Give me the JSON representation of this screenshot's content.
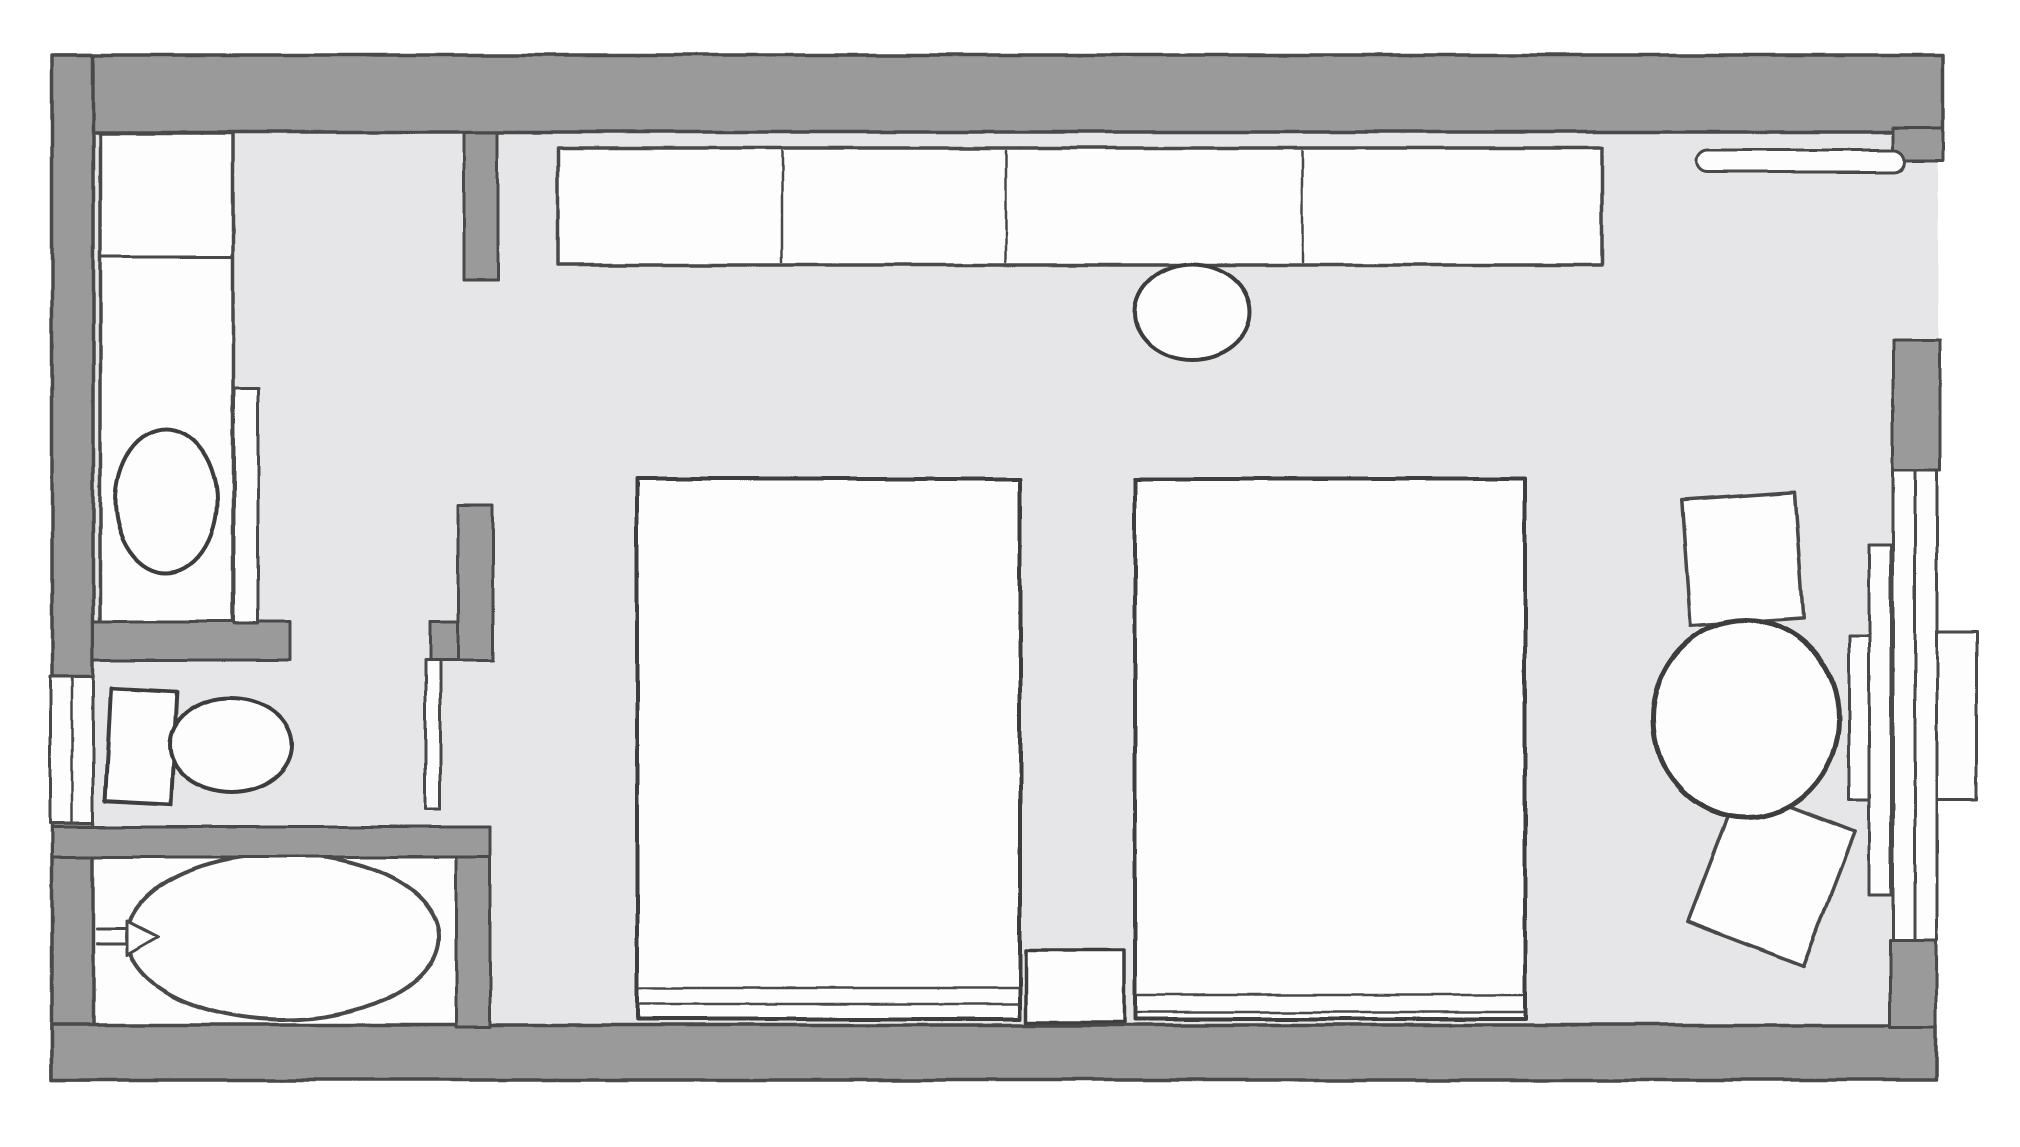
{
  "canvas": {
    "width": 2020,
    "height": 1147
  },
  "palette": {
    "bg": "#ffffff",
    "floor": "#e6e6e8",
    "wall": "#9a9a9a",
    "fixture": "#fdfdfd",
    "outline": "#4a4a4a",
    "outline_dark": "#3c3c3c"
  },
  "shapes": [
    {
      "name": "room-floor",
      "type": "rect",
      "x": 58,
      "y": 58,
      "w": 1880,
      "h": 1020,
      "fill": "floor",
      "stroke": "none",
      "sw": 0
    },
    {
      "name": "bathtub-room-floor",
      "type": "rect",
      "x": 90,
      "y": 843,
      "w": 368,
      "h": 186,
      "fill": "fixture",
      "stroke": "outline",
      "sw": 3
    },
    {
      "name": "vanity-counter",
      "type": "rect",
      "x": 100,
      "y": 133,
      "w": 133,
      "h": 492,
      "fill": "fixture",
      "stroke": "outline",
      "sw": 3.5
    },
    {
      "name": "vanity-shelf-divider-line",
      "type": "line",
      "x1": 100,
      "y1": 257,
      "x2": 233,
      "y2": 257,
      "fill": "none",
      "stroke": "outline",
      "sw": 3
    },
    {
      "name": "sink-basin",
      "type": "ellipse",
      "cx": 166,
      "cy": 501,
      "rx": 51,
      "ry": 72,
      "fill": "fixture",
      "stroke": "outline_dark",
      "sw": 4
    },
    {
      "name": "wardrobe-console-cabinet",
      "type": "rect",
      "x": 558,
      "y": 148,
      "w": 1044,
      "h": 117,
      "fill": "fixture",
      "stroke": "outline",
      "sw": 3.5
    },
    {
      "name": "cabinet-divider-line-1",
      "type": "line",
      "x1": 782,
      "y1": 151,
      "x2": 782,
      "y2": 262,
      "fill": "none",
      "stroke": "outline",
      "sw": 2.5
    },
    {
      "name": "cabinet-divider-line-2",
      "type": "line",
      "x1": 1006,
      "y1": 151,
      "x2": 1006,
      "y2": 262,
      "fill": "none",
      "stroke": "outline",
      "sw": 2.5
    },
    {
      "name": "cabinet-divider-line-3",
      "type": "line",
      "x1": 1302,
      "y1": 151,
      "x2": 1302,
      "y2": 262,
      "fill": "none",
      "stroke": "outline",
      "sw": 2.5
    },
    {
      "name": "stool-seat",
      "type": "ellipse",
      "cx": 1192,
      "cy": 312,
      "rx": 58,
      "ry": 48,
      "fill": "fixture",
      "stroke": "outline_dark",
      "sw": 4
    },
    {
      "name": "bed-left",
      "type": "rect",
      "x": 637,
      "y": 479,
      "w": 383,
      "h": 540,
      "fill": "fixture",
      "stroke": "outline_dark",
      "sw": 4
    },
    {
      "name": "bed-left-headboard-line-1",
      "type": "line",
      "x1": 640,
      "y1": 988,
      "x2": 1018,
      "y2": 988,
      "fill": "none",
      "stroke": "outline",
      "sw": 2.5
    },
    {
      "name": "bed-left-headboard-line-2",
      "type": "line",
      "x1": 640,
      "y1": 1004,
      "x2": 1018,
      "y2": 1004,
      "fill": "none",
      "stroke": "outline",
      "sw": 2.5
    },
    {
      "name": "bed-right",
      "type": "rect",
      "x": 1135,
      "y": 479,
      "w": 390,
      "h": 540,
      "fill": "fixture",
      "stroke": "outline_dark",
      "sw": 4
    },
    {
      "name": "bed-right-headboard-line-1",
      "type": "line",
      "x1": 1138,
      "y1": 995,
      "x2": 1522,
      "y2": 995,
      "fill": "none",
      "stroke": "outline",
      "sw": 2.5
    },
    {
      "name": "bed-right-headboard-line-2",
      "type": "line",
      "x1": 1138,
      "y1": 1012,
      "x2": 1522,
      "y2": 1012,
      "fill": "none",
      "stroke": "outline",
      "sw": 2.5
    },
    {
      "name": "nightstand",
      "type": "rect",
      "x": 1026,
      "y": 950,
      "w": 98,
      "h": 72,
      "fill": "fixture",
      "stroke": "outline_dark",
      "sw": 3.5
    },
    {
      "name": "chair-top",
      "type": "rect",
      "x": 1686,
      "y": 496,
      "w": 113,
      "h": 126,
      "rot": -4,
      "fill": "fixture",
      "stroke": "outline",
      "sw": 3.5
    },
    {
      "name": "chair-bottom",
      "type": "rect",
      "x": 1709,
      "y": 805,
      "w": 124,
      "h": 144,
      "rot": 21,
      "fill": "fixture",
      "stroke": "outline",
      "sw": 3.5
    },
    {
      "name": "round-table",
      "type": "ellipse",
      "cx": 1746,
      "cy": 719,
      "rx": 93,
      "ry": 99,
      "fill": "fixture",
      "stroke": "outline_dark",
      "sw": 5
    },
    {
      "name": "bathtub",
      "type": "ellipse",
      "cx": 283,
      "cy": 937,
      "rx": 156,
      "ry": 83,
      "fill": "fixture",
      "stroke": "outline",
      "sw": 4
    },
    {
      "name": "bathtub-faucet",
      "type": "path",
      "d": "M97 929 L127 929 M97 944 L127 944 M127 921 L158 937 L127 955 Z",
      "fill": "fixture",
      "stroke": "outline",
      "sw": 3
    },
    {
      "name": "toilet-tank",
      "type": "rect",
      "x": 108,
      "y": 690,
      "w": 66,
      "h": 113,
      "rot": 3,
      "fill": "fixture",
      "stroke": "outline_dark",
      "sw": 4
    },
    {
      "name": "toilet-bowl",
      "type": "ellipse",
      "cx": 231,
      "cy": 745,
      "rx": 61,
      "ry": 47,
      "fill": "fixture",
      "stroke": "outline_dark",
      "sw": 4
    },
    {
      "name": "wall-top",
      "type": "rect",
      "x": 55,
      "y": 55,
      "w": 1888,
      "h": 77,
      "fill": "wall",
      "stroke": "outline",
      "sw": 3.5
    },
    {
      "name": "wall-top-right-corner",
      "type": "rect",
      "x": 1893,
      "y": 128,
      "w": 50,
      "h": 32,
      "fill": "wall",
      "stroke": "outline",
      "sw": 3
    },
    {
      "name": "wall-left-upper",
      "type": "rect",
      "x": 52,
      "y": 55,
      "w": 41,
      "h": 622,
      "fill": "wall",
      "stroke": "outline",
      "sw": 3.5
    },
    {
      "name": "wall-left-lower",
      "type": "rect",
      "x": 52,
      "y": 823,
      "w": 41,
      "h": 257,
      "fill": "wall",
      "stroke": "outline",
      "sw": 3.5
    },
    {
      "name": "wall-bottom",
      "type": "rect",
      "x": 52,
      "y": 1025,
      "w": 1884,
      "h": 55,
      "fill": "wall",
      "stroke": "outline",
      "sw": 3.5
    },
    {
      "name": "wall-vanity-toilet-divider",
      "type": "rect",
      "x": 93,
      "y": 622,
      "w": 197,
      "h": 38,
      "fill": "wall",
      "stroke": "outline",
      "sw": 3
    },
    {
      "name": "wall-corridor-vertical",
      "type": "rect",
      "x": 458,
      "y": 505,
      "w": 35,
      "h": 155,
      "fill": "wall",
      "stroke": "outline",
      "sw": 3
    },
    {
      "name": "wall-corridor-stub",
      "type": "rect",
      "x": 430,
      "y": 622,
      "w": 28,
      "h": 38,
      "fill": "wall",
      "stroke": "outline",
      "sw": 3
    },
    {
      "name": "wall-entry-stub",
      "type": "rect",
      "x": 464,
      "y": 132,
      "w": 34,
      "h": 148,
      "fill": "wall",
      "stroke": "outline",
      "sw": 3
    },
    {
      "name": "wall-tubroom-right",
      "type": "rect",
      "x": 456,
      "y": 827,
      "w": 34,
      "h": 200,
      "fill": "wall",
      "stroke": "outline",
      "sw": 3
    },
    {
      "name": "wall-toilet-tub-divider",
      "type": "rect",
      "x": 52,
      "y": 827,
      "w": 438,
      "h": 30,
      "fill": "wall",
      "stroke": "outline",
      "sw": 3
    },
    {
      "name": "wall-window-pier-top",
      "type": "rect",
      "x": 1893,
      "y": 340,
      "w": 47,
      "h": 130,
      "fill": "wall",
      "stroke": "outline",
      "sw": 3
    },
    {
      "name": "wall-window-pier-bottom",
      "type": "rect",
      "x": 1890,
      "y": 940,
      "w": 46,
      "h": 87,
      "fill": "wall",
      "stroke": "outline",
      "sw": 3
    },
    {
      "name": "left-window-opening",
      "type": "rect",
      "x": 50,
      "y": 677,
      "w": 43,
      "h": 146,
      "fill": "fixture",
      "stroke": "outline",
      "sw": 3
    },
    {
      "name": "left-window-glazing-line",
      "type": "line",
      "x1": 72,
      "y1": 677,
      "x2": 72,
      "y2": 823,
      "fill": "none",
      "stroke": "outline",
      "sw": 2.5
    },
    {
      "name": "door-leaf-vanity",
      "type": "rect",
      "x": 234,
      "y": 388,
      "w": 24,
      "h": 236,
      "fill": "fixture",
      "stroke": "outline",
      "sw": 3
    },
    {
      "name": "door-leaf-toilet",
      "type": "rect",
      "x": 425,
      "y": 660,
      "w": 15,
      "h": 150,
      "fill": "fixture",
      "stroke": "outline",
      "sw": 3
    },
    {
      "name": "window-glazing-outer",
      "type": "rect",
      "x": 1915,
      "y": 470,
      "w": 22,
      "h": 470,
      "fill": "fixture",
      "stroke": "outline",
      "sw": 3
    },
    {
      "name": "window-glazing-inner",
      "type": "rect",
      "x": 1893,
      "y": 470,
      "w": 22,
      "h": 470,
      "fill": "fixture",
      "stroke": "outline",
      "sw": 3
    },
    {
      "name": "window-inner-strip",
      "type": "rect",
      "x": 1869,
      "y": 545,
      "w": 22,
      "h": 350,
      "fill": "fixture",
      "stroke": "outline",
      "sw": 3
    },
    {
      "name": "window-inner-sill",
      "type": "rect",
      "x": 1849,
      "y": 635,
      "w": 20,
      "h": 165,
      "fill": "fixture",
      "stroke": "outline",
      "sw": 3
    },
    {
      "name": "window-outer-sill",
      "type": "rect",
      "x": 1937,
      "y": 632,
      "w": 40,
      "h": 168,
      "fill": "fixture",
      "stroke": "outline",
      "sw": 3
    },
    {
      "name": "curtain-rail",
      "type": "rect",
      "x": 1697,
      "y": 150,
      "w": 208,
      "h": 22,
      "rx": 11,
      "fill": "fixture",
      "stroke": "outline",
      "sw": 3
    }
  ]
}
